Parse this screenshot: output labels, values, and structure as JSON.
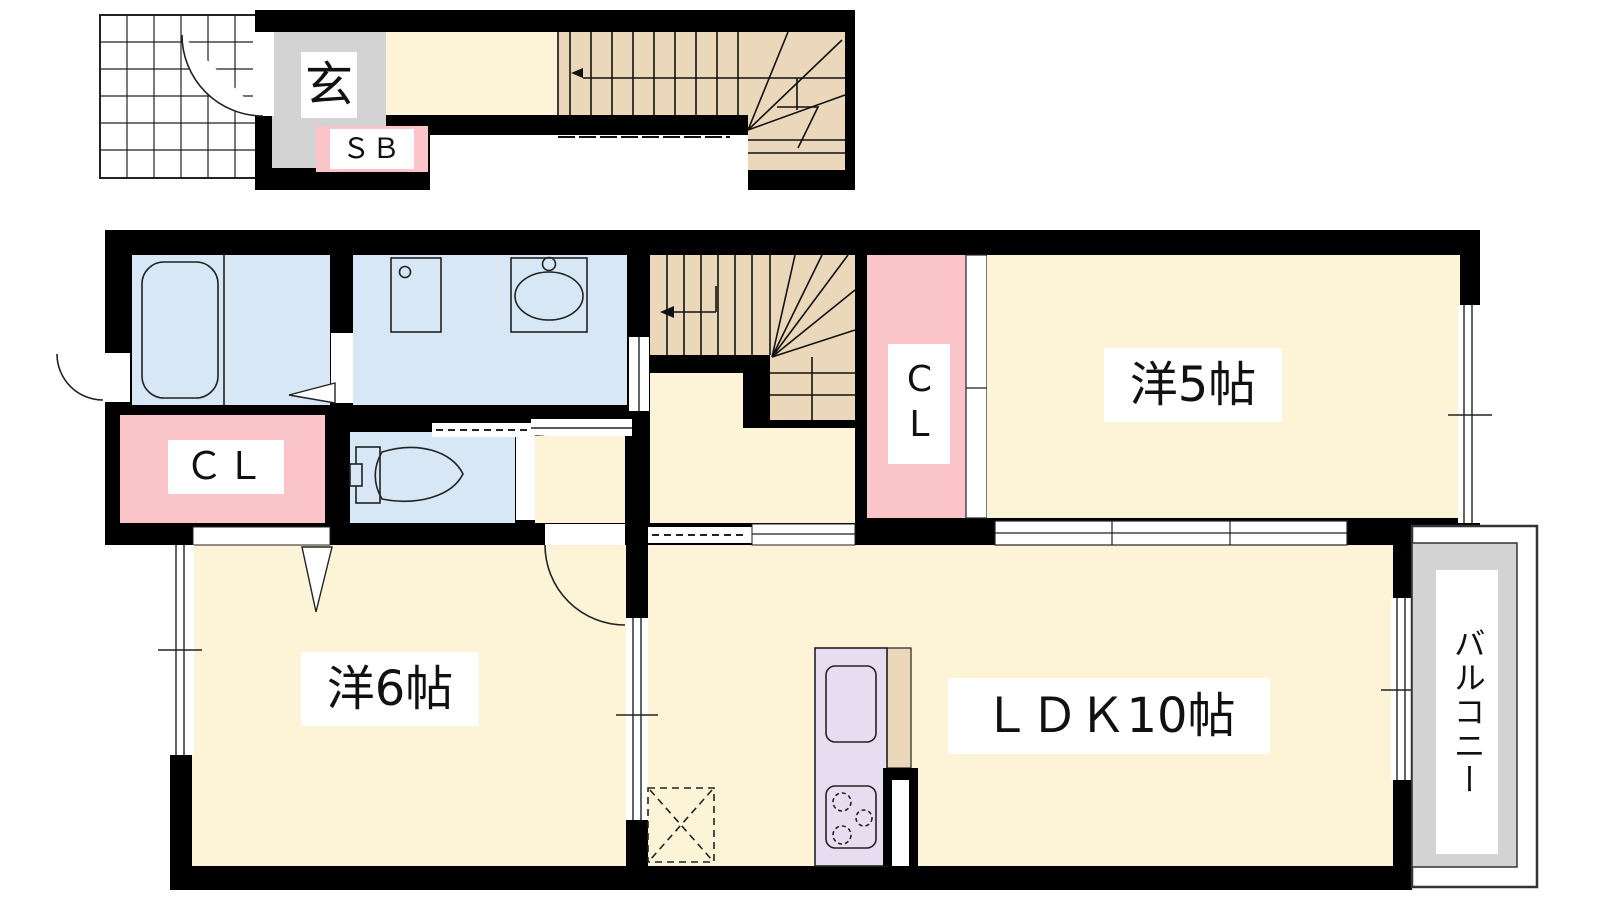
{
  "plan": {
    "labels": {
      "entrance": "玄",
      "shoe_box": "ＳＢ",
      "closet_left": "ＣＬ",
      "closet_center": "CL",
      "room5": "洋5帖",
      "room6": "洋6帖",
      "ldk": "ＬＤＫ10帖",
      "balcony": "バルコニー"
    },
    "colors": {
      "floor": "#FDF3D7",
      "stairs": "#EBD8BA",
      "wet_area": "#D8E7F5",
      "closet": "#FAC4C8",
      "kitchen": "#E7DDF1",
      "entrance_floor": "#D3D3D3",
      "balcony": "#D3D3D3",
      "counter": "#EBD8BA",
      "wall": "#000000"
    }
  }
}
